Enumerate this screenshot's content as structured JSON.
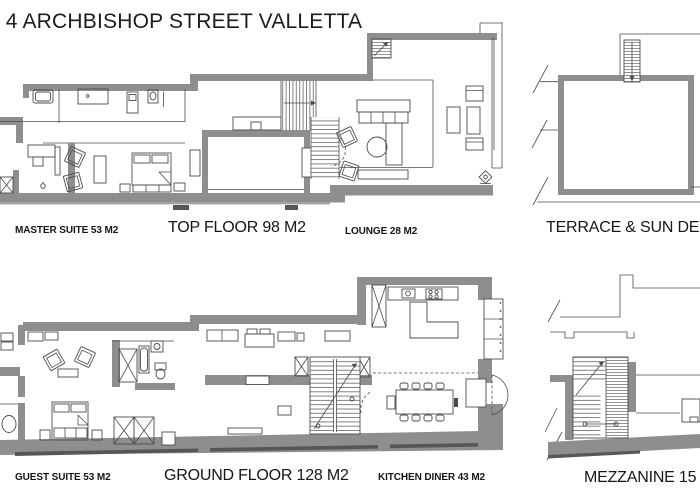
{
  "title": {
    "prefix_partial": "T",
    "text": "4 ARCHBISHOP STREET VALLETTA"
  },
  "labels": {
    "master_suite": "MASTER SUITE 53 M2",
    "top_floor": "TOP FLOOR 98 M2",
    "lounge": "LOUNGE 28 M2",
    "terrace": "TERRACE & SUN DECK",
    "guest_suite": "GUEST SUITE 53 M2",
    "ground_floor": "GROUND FLOOR 128 M2",
    "kitchen_diner": "KITCHEN DINER 43 M2",
    "mezzanine": "MEZZANINE 15 M2"
  },
  "colors": {
    "background": "#ffffff",
    "wall": "#8e8e8e",
    "line": "#4c4c4c",
    "text": "#161616"
  },
  "icons": [
    "stairs-icon",
    "bed-icon",
    "bathtub-icon",
    "shower-icon",
    "sink-icon",
    "toilet-icon",
    "armchair-icon",
    "sofa-icon",
    "round-table-icon",
    "dining-table-icon",
    "kitchen-counter-icon",
    "hob-icon",
    "column-icon",
    "wardrobe-icon",
    "balcony-bay-icon",
    "floor-light-icon",
    "break-mark-icon"
  ]
}
